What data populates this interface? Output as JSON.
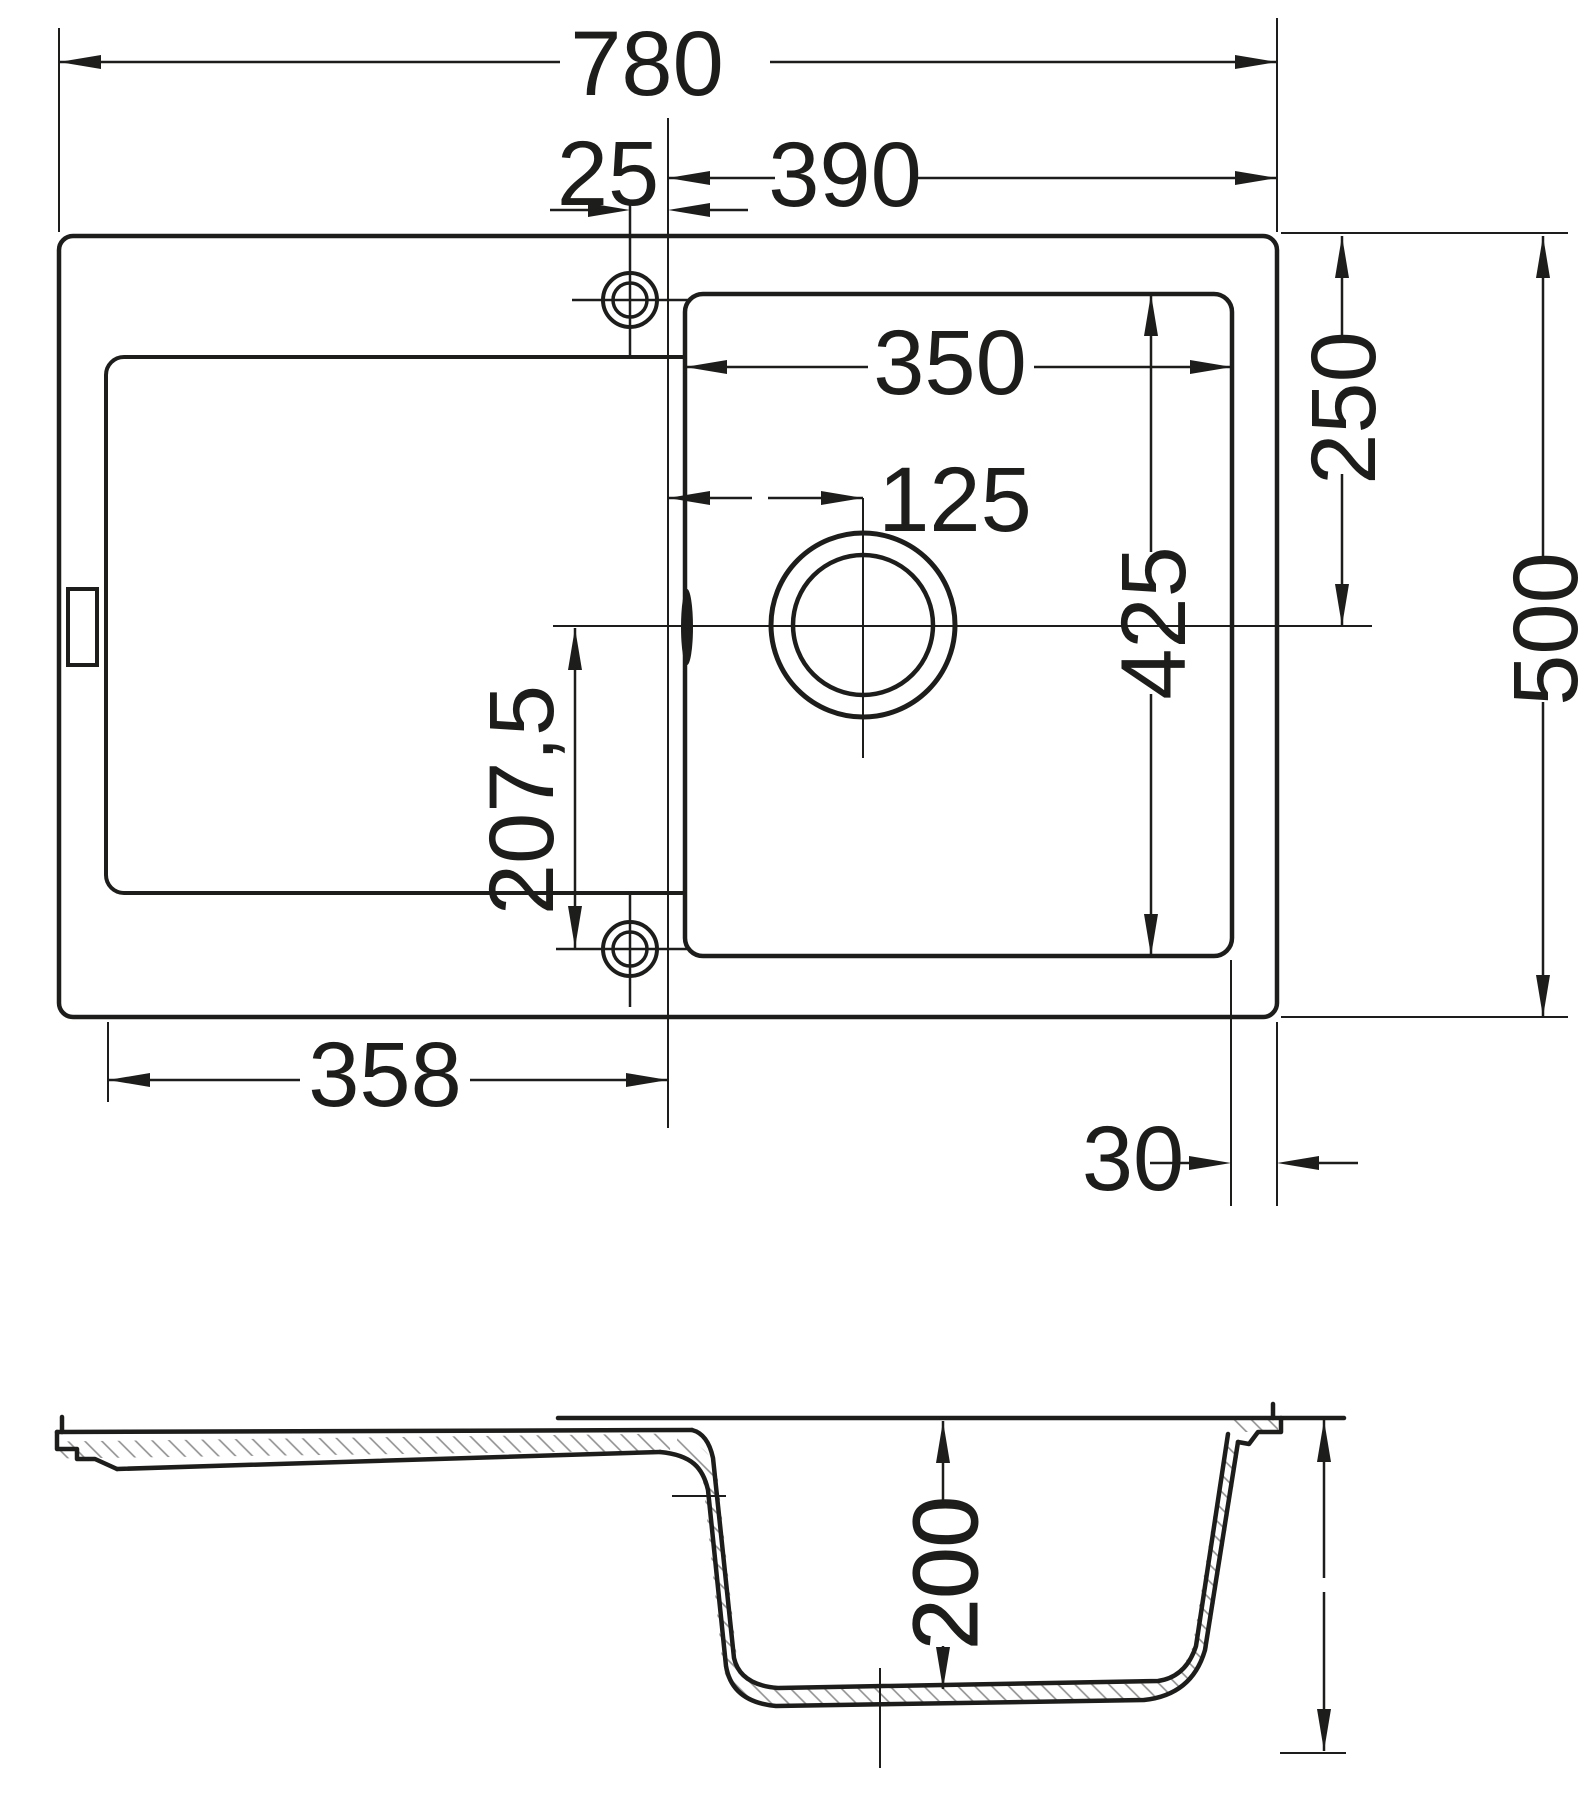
{
  "drawing": {
    "kind": "sink-technical-drawing",
    "colors": {
      "line": "#1d1d1b",
      "background": "#ffffff",
      "hatch": "#9a9a9a"
    },
    "plan": {
      "dim_overall_width": "780",
      "dim_tap_to_bowl": "25",
      "dim_bowl_line_to_right": "390",
      "dim_bowl_width": "350",
      "dim_drain_offset": "125",
      "dim_top_to_drain": "250",
      "dim_bowl_length": "425",
      "dim_overall_depth": "500",
      "dim_drain_to_taphole": "207,5",
      "dim_drainer_span": "358",
      "dim_bowl_to_edge": "30"
    },
    "section": {
      "dim_bowl_depth": "200"
    }
  }
}
